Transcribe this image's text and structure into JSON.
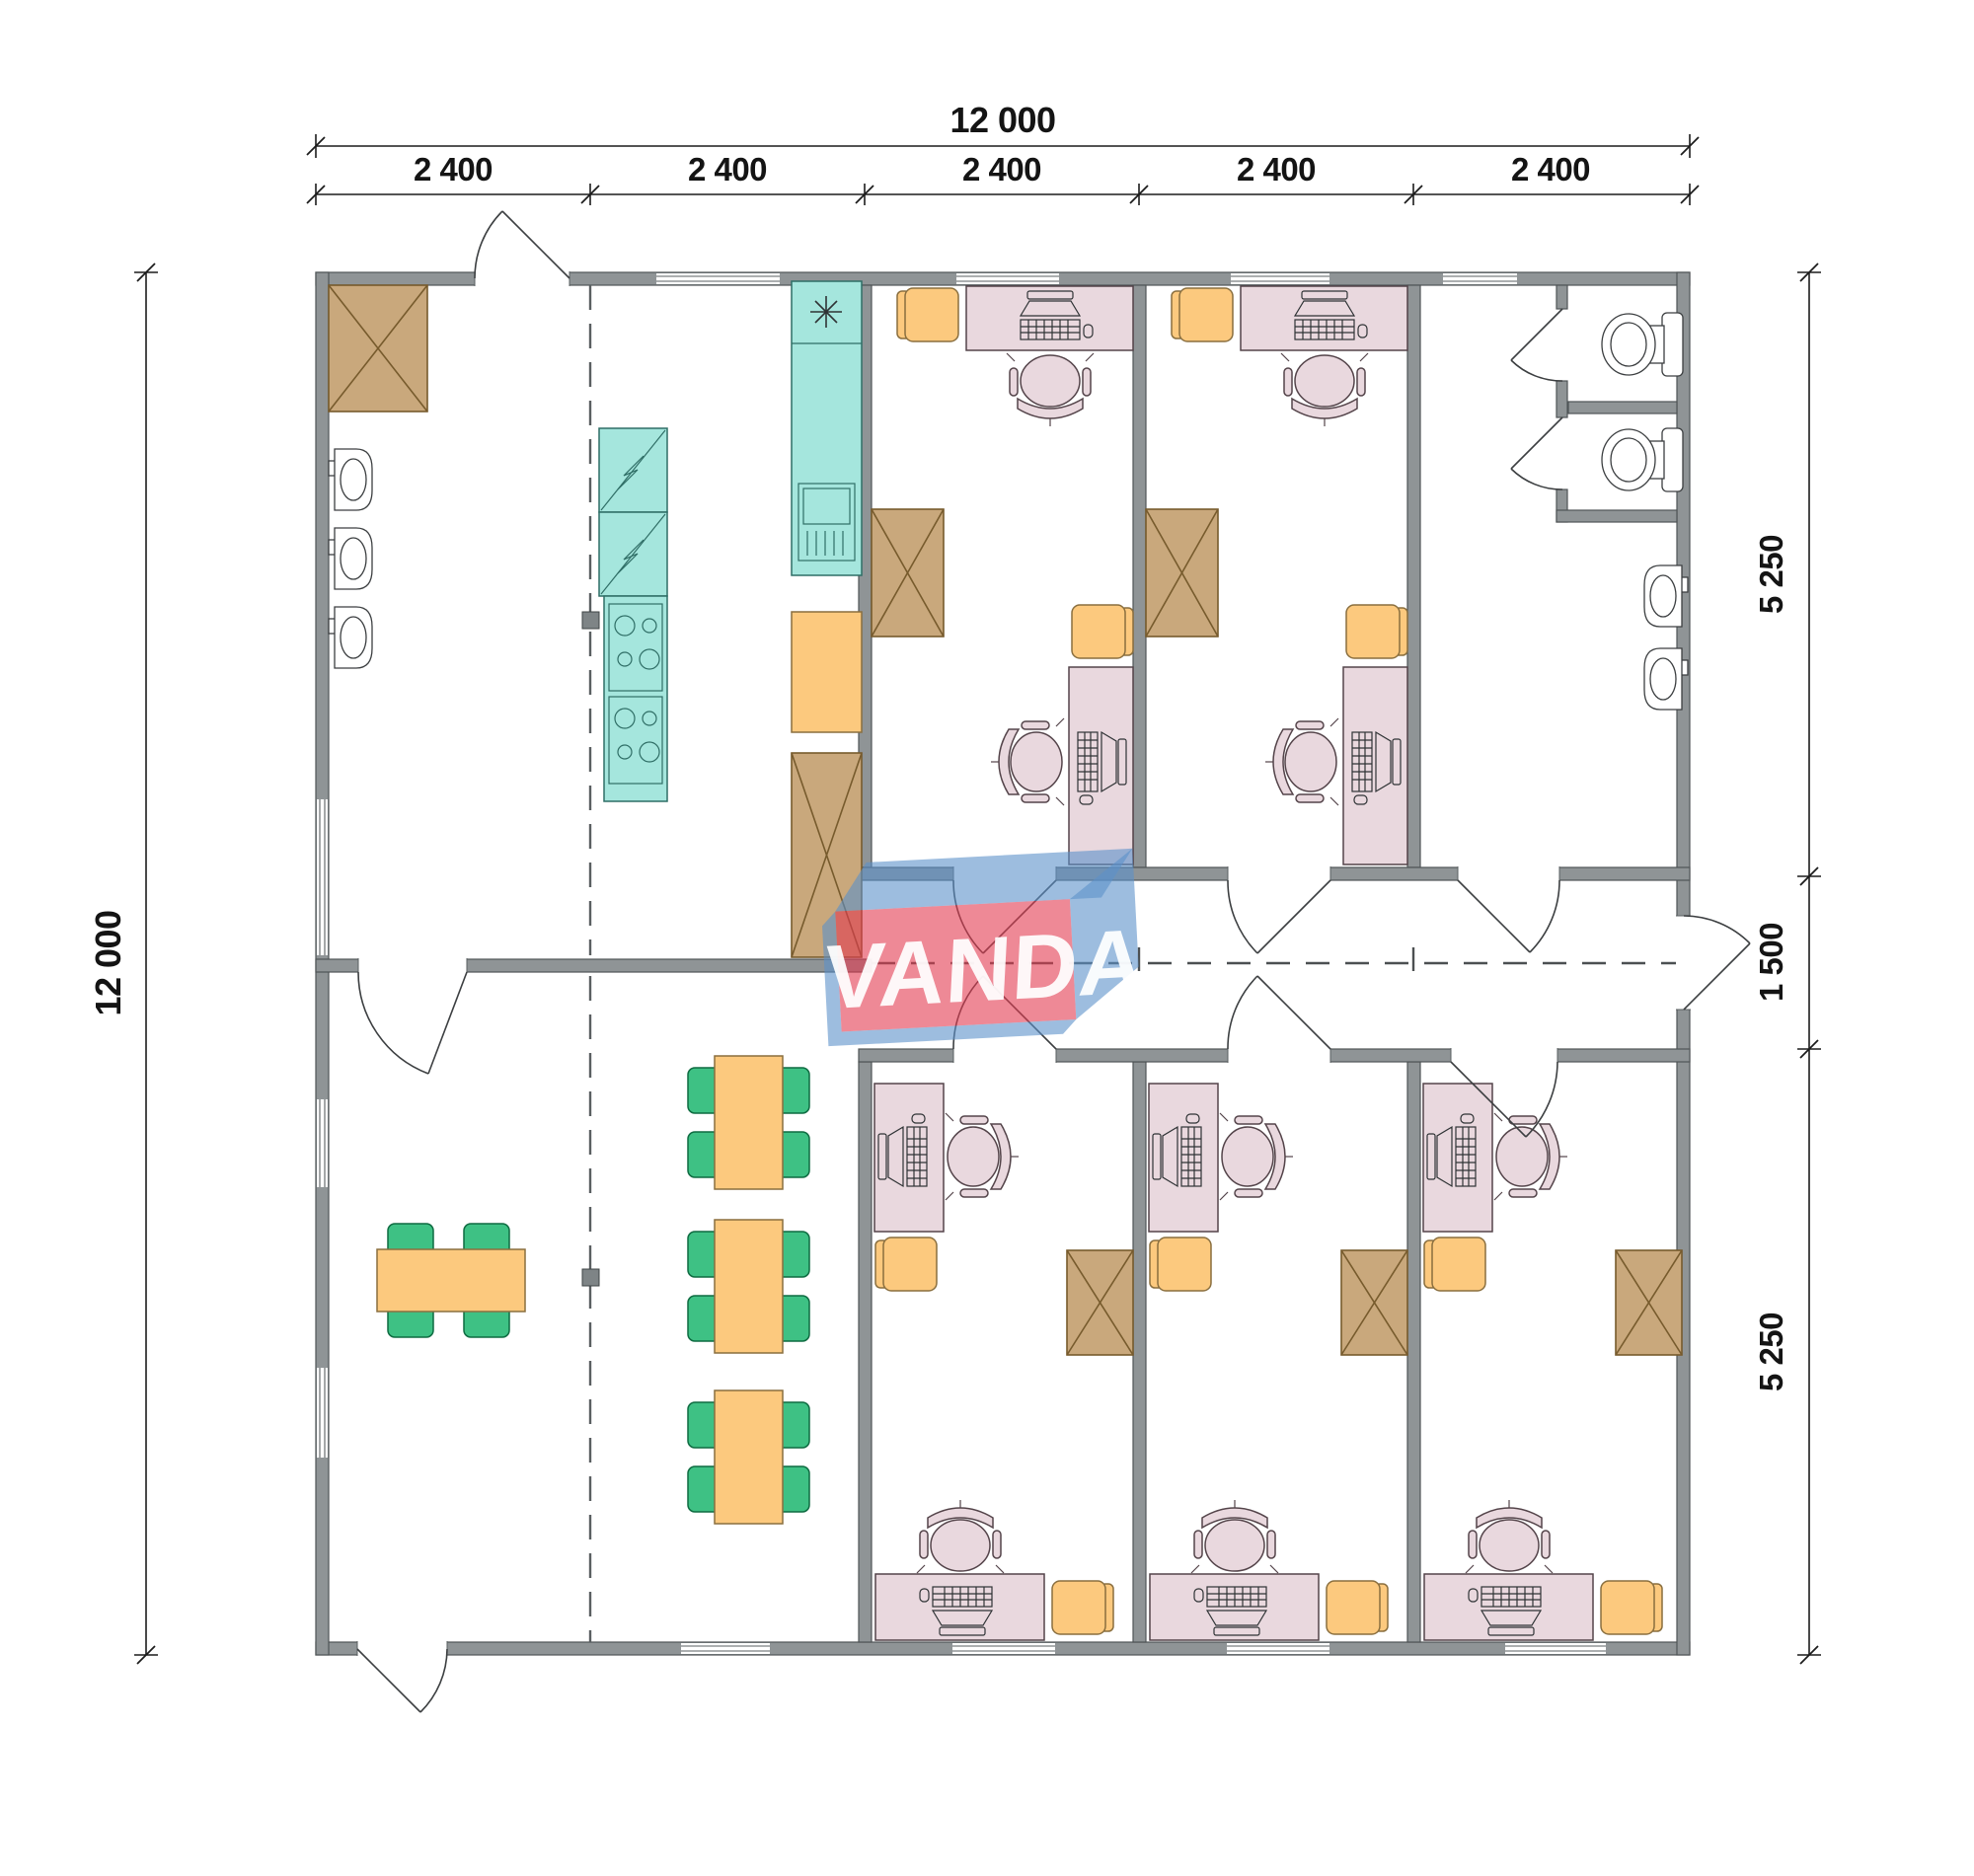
{
  "logo": {
    "text": "VANDA"
  },
  "dimensions": {
    "top_total": "12 000",
    "top_segments": [
      "2 400",
      "2 400",
      "2 400",
      "2 400",
      "2 400"
    ],
    "left_total": "12 000",
    "right_segments": [
      "5 250",
      "1 500",
      "5 250"
    ]
  },
  "colors": {
    "wall": "#8f9496",
    "wall_edge": "#4f5456",
    "line": "#1c1c1c",
    "dim_text": "#141414",
    "teal": "#a5e6dd",
    "teal_edge": "#2f6e66",
    "brown": "#c9a87c",
    "brown_edge": "#775b2d",
    "orange": "#fcc97e",
    "orange_edge": "#8a6f3f",
    "pink": "#e9d8de",
    "pink_edge": "#54444a",
    "green": "#3ec184",
    "green_edge": "#0e6b41",
    "logo_red": "#e23a50",
    "logo_blue": "#5c91c9"
  }
}
